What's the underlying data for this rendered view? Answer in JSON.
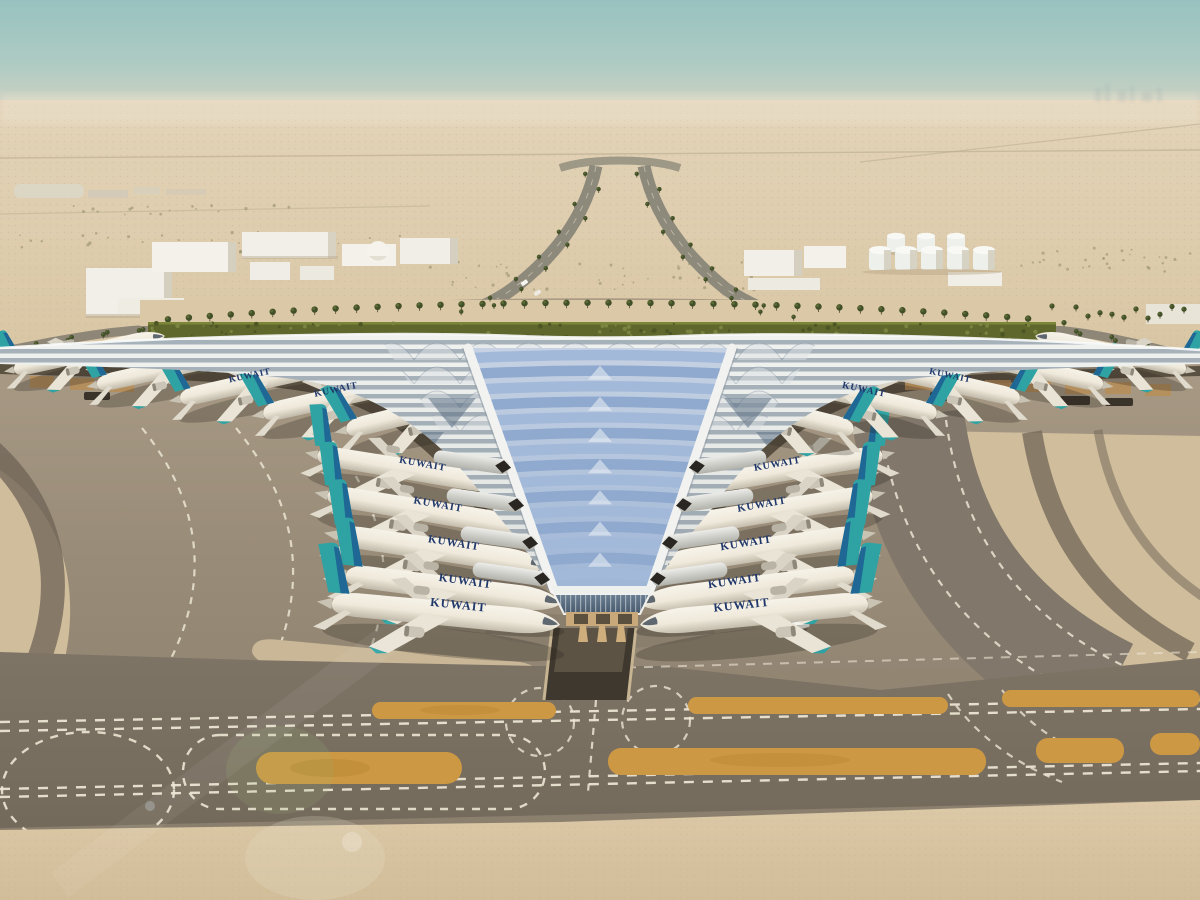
{
  "scene": {
    "title": "Aerial rendering of a new desert airport passenger terminal",
    "environment": "Flat desert under a hazy teal sky, horizon haze band",
    "landmarks": [
      "Trefoil swooping terminal roof with blue ribbed skylight wedge",
      "Rows of airliners with teal tails parked nose-in at both wings",
      "Green hedge belt and palm-lined boulevard behind the roof apex",
      "V-shaped landscaped approach roads from the horizon",
      "White warehouse buildings and domed building at left",
      "White fuel storage tanks at right",
      "Curved taxiways with dashed white guidance lines",
      "Orange painted strips on the crosswind taxiway",
      "Service tunnel ramp below the terminal tip",
      "Small service vehicle and worker on the apron",
      "Soft green lens flare at lower left"
    ]
  },
  "airline": {
    "title": "KUWAIT",
    "aircraft_count": 20,
    "tail_color": "#2fa3a3",
    "tail_stripe_color": "#1e6094",
    "title_color": "#21386b",
    "fuselage_color": "#f2eee4"
  },
  "aircraft": {
    "placements": [
      [
        12,
        368,
        -12,
        158,
        0,
        0
      ],
      [
        95,
        383,
        -12,
        168,
        0,
        0
      ],
      [
        178,
        397,
        -12,
        176,
        0,
        1
      ],
      [
        261,
        412,
        -12,
        184,
        0,
        1
      ],
      [
        344,
        428,
        -13,
        188,
        0,
        0
      ],
      [
        316,
        452,
        10,
        196,
        0,
        1
      ],
      [
        326,
        492,
        10,
        206,
        0,
        1
      ],
      [
        336,
        532,
        9,
        216,
        0,
        1
      ],
      [
        344,
        572,
        8,
        222,
        0,
        1
      ],
      [
        330,
        600,
        6,
        234,
        0,
        1
      ],
      [
        884,
        452,
        10,
        196,
        1,
        1
      ],
      [
        874,
        492,
        10,
        206,
        1,
        1
      ],
      [
        864,
        532,
        9,
        216,
        1,
        1
      ],
      [
        856,
        572,
        8,
        222,
        1,
        1
      ],
      [
        870,
        600,
        6,
        234,
        1,
        1
      ],
      [
        1188,
        368,
        -12,
        158,
        1,
        0
      ],
      [
        1105,
        383,
        -12,
        168,
        1,
        0
      ],
      [
        1022,
        397,
        -12,
        176,
        1,
        1
      ],
      [
        939,
        412,
        -12,
        184,
        1,
        1
      ],
      [
        856,
        428,
        -13,
        188,
        1,
        0
      ]
    ]
  },
  "palette": {
    "sky_top": "#98c2c0",
    "sky_horizon": "#e0d5bf",
    "desert": "#e0cfb2",
    "hedge_green": "#5f672c",
    "palm_green": "#42502a",
    "palm_trunk": "#6b6147",
    "roof_silver": "#e9ebe8",
    "roof_slate": "#5d7186",
    "skylight_blue": "#8fa9cf",
    "skylight_light": "#a3b9da",
    "canopy_tan": "#c9a97a",
    "apron_gray": "#998c78",
    "taxiway_dark": "#7b7163",
    "marking_white": "#ece5d3",
    "marking_orange": "#cd9843",
    "sand_light": "#dbc8a6",
    "gold_canopy": "#b98a4a",
    "scrub_green": "#8a855f"
  }
}
